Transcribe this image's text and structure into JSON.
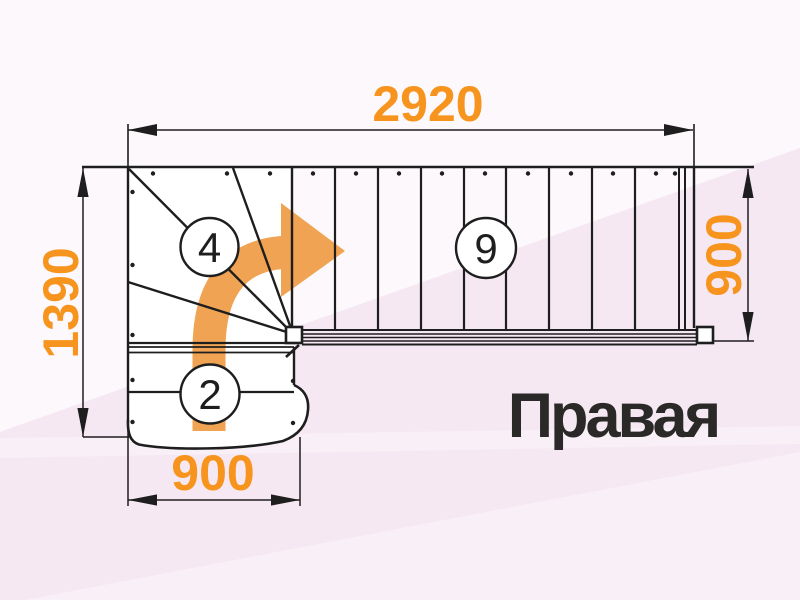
{
  "diagram": {
    "type": "staircase-plan",
    "title_label": "Правая",
    "dimensions": {
      "top_width": "2920",
      "left_height": "1390",
      "right_height": "900",
      "bottom_width": "900"
    },
    "step_labels": {
      "winder_flight": "4",
      "straight_flight": "9",
      "lower_flight": "2"
    },
    "icons": {
      "direction_arrow": "curved-right-arrow"
    },
    "colors": {
      "accent_orange": "#f7941d",
      "arrow_orange": "#f0a352",
      "line_black": "#1e1e1e",
      "label_dark": "#2a2927",
      "bg_base": "#fcf8fb",
      "bg_pink": "#f5e8f2",
      "bg_pink_light": "#f9eff6"
    }
  }
}
